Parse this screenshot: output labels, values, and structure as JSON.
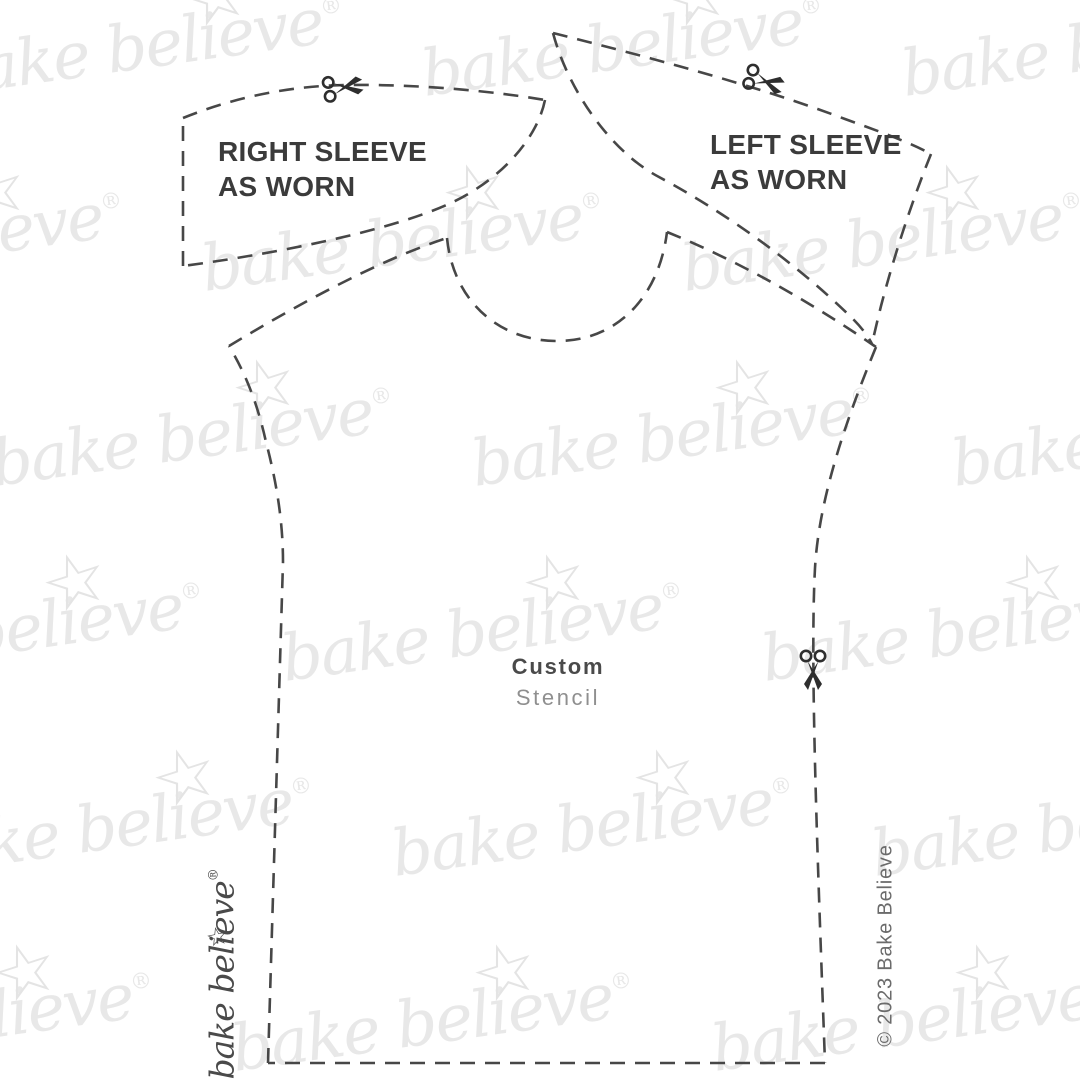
{
  "pattern": {
    "right_sleeve_label": "RIGHT SLEEVE\nAS WORN",
    "left_sleeve_label": "LEFT SLEEVE\nAS WORN",
    "center_label_primary": "Custom",
    "center_label_secondary": "Stencil"
  },
  "branding": {
    "logo_text": "bake believe",
    "logo_reg": "®",
    "logo_star": "☆",
    "copyright": "© 2023 Bake Believe"
  },
  "watermark": {
    "text": "bake believe",
    "reg": "®",
    "star": "☆",
    "color": "#e8e8e8"
  },
  "icons": {
    "scissors": "scissors-icon",
    "star": "star-icon"
  },
  "colors": {
    "background": "#ffffff",
    "dash_line": "#474747",
    "scissors": "#2e2e2e",
    "label_text": "#3b3b3b",
    "primary_text": "#4a4a4a",
    "secondary_text": "#8f8f8f",
    "copyright_text": "#6b6b6b",
    "watermark_text": "#e8e8e8"
  }
}
